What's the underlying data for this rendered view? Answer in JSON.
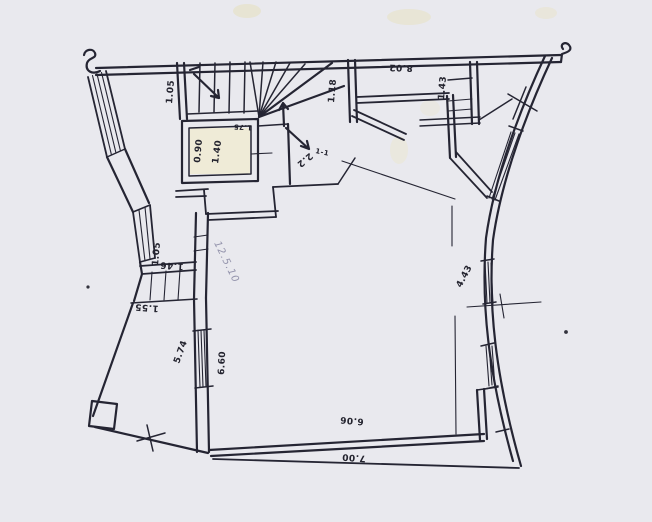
{
  "document": {
    "type": "hand-drawn architectural floor plan sketch (scanned)",
    "paper_color": "#e9e9ee",
    "ink_color": "#252533",
    "pencil_color": "#8585a0"
  },
  "labels": {
    "dim_top_corridor": "1.05",
    "dim_hall_top": "8.02",
    "dim_shaft": "1.18",
    "dim_duct": "1.43",
    "dim_wc_width": "0.90",
    "dim_wc_depth": "1.40",
    "dim_niche": "1.75",
    "dim_stair_opening": "2.2",
    "section_mark": "1-1",
    "dim_right_wall": "4.43",
    "dim_left_wall": "1.05",
    "dim_entry": "1.46",
    "dim_porch": "1.55",
    "dim_annex_side": "5.74",
    "dim_left_window": "6.60",
    "dim_room_width": "6.06",
    "dim_outer_width": "7.00",
    "pencil_note": "12.5.10"
  }
}
